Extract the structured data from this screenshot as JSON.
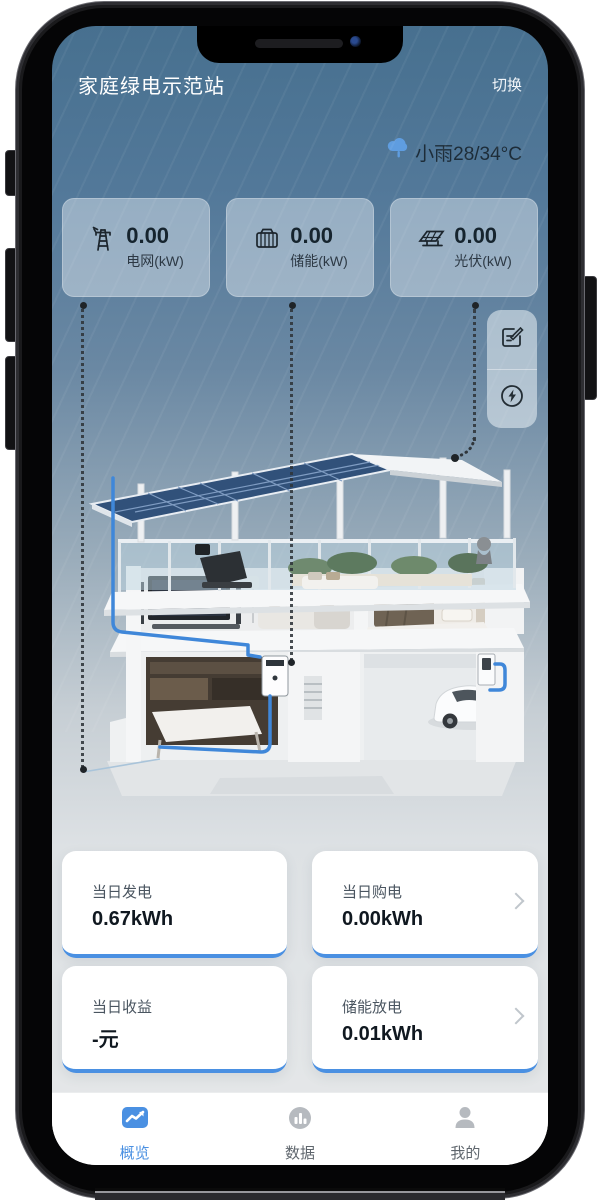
{
  "header": {
    "title": "家庭绿电示范站",
    "switch_label": "切换"
  },
  "weather": {
    "text": "小雨28/34°C",
    "icon": "rain-cloud-icon"
  },
  "stats": [
    {
      "icon": "power-grid-tower-icon",
      "value": "0.00",
      "label": "电网(kW)"
    },
    {
      "icon": "battery-storage-icon",
      "value": "0.00",
      "label": "储能(kW)"
    },
    {
      "icon": "solar-panel-icon",
      "value": "0.00",
      "label": "光伏(kW)"
    }
  ],
  "quick_actions": [
    {
      "icon": "edit-form-icon"
    },
    {
      "icon": "energy-flash-icon"
    }
  ],
  "summary_cards": [
    {
      "label": "当日发电",
      "value": "0.67kWh"
    },
    {
      "label": "当日购电",
      "value": "0.00kWh"
    },
    {
      "label": "当日收益",
      "value": "-元"
    },
    {
      "label": "储能放电",
      "value": "0.01kWh"
    }
  ],
  "tabbar": [
    {
      "label": "概览",
      "active": true,
      "icon": "overview-chart-icon"
    },
    {
      "label": "数据",
      "active": false,
      "icon": "data-bars-icon"
    },
    {
      "label": "我的",
      "active": false,
      "icon": "profile-icon"
    }
  ],
  "colors": {
    "accent": "#4a90e2",
    "flow_line": "#3f87d9"
  }
}
